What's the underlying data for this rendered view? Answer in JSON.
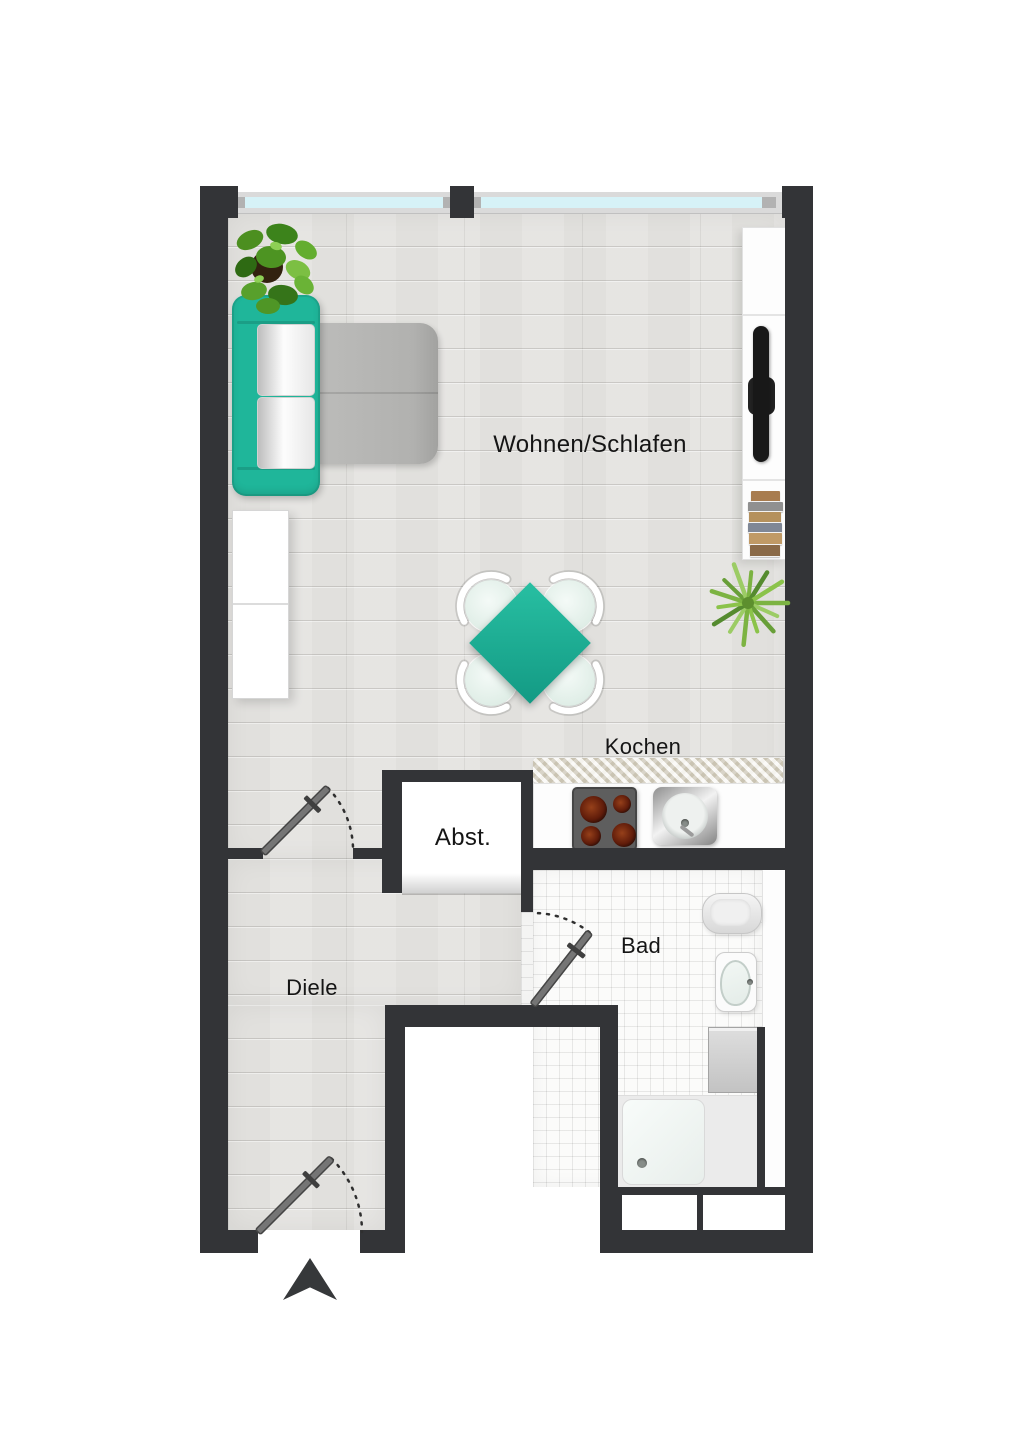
{
  "meta": {
    "type": "apartment-floor-plan",
    "entrance_arrow_direction": "up"
  },
  "rooms": [
    {
      "id": "living-sleeping",
      "label": "Wohnen/Schlafen"
    },
    {
      "id": "kitchen",
      "label": "Kochen"
    },
    {
      "id": "storage",
      "label": "Abst."
    },
    {
      "id": "bathroom",
      "label": "Bad"
    },
    {
      "id": "hallway",
      "label": "Diele"
    }
  ],
  "colors": {
    "wall": "#333437",
    "accent_teal": "#1fb69a",
    "wood_floor": "#e5e4e1",
    "tile_floor": "#fbfbfa",
    "window_glass": "#d6f2f7",
    "bed_pad_gray": "#b1b1af",
    "plant_green": "#7cb342"
  },
  "furniture": [
    "sofa",
    "bed-pad",
    "wardrobe",
    "jade-plant",
    "dining-table",
    "chairs",
    "spiky-plant",
    "sideboard",
    "tv",
    "book-stack",
    "cooktop",
    "kitchen-sink",
    "kitchen-rug",
    "toilet",
    "washbasin",
    "washing-machine",
    "shower"
  ]
}
